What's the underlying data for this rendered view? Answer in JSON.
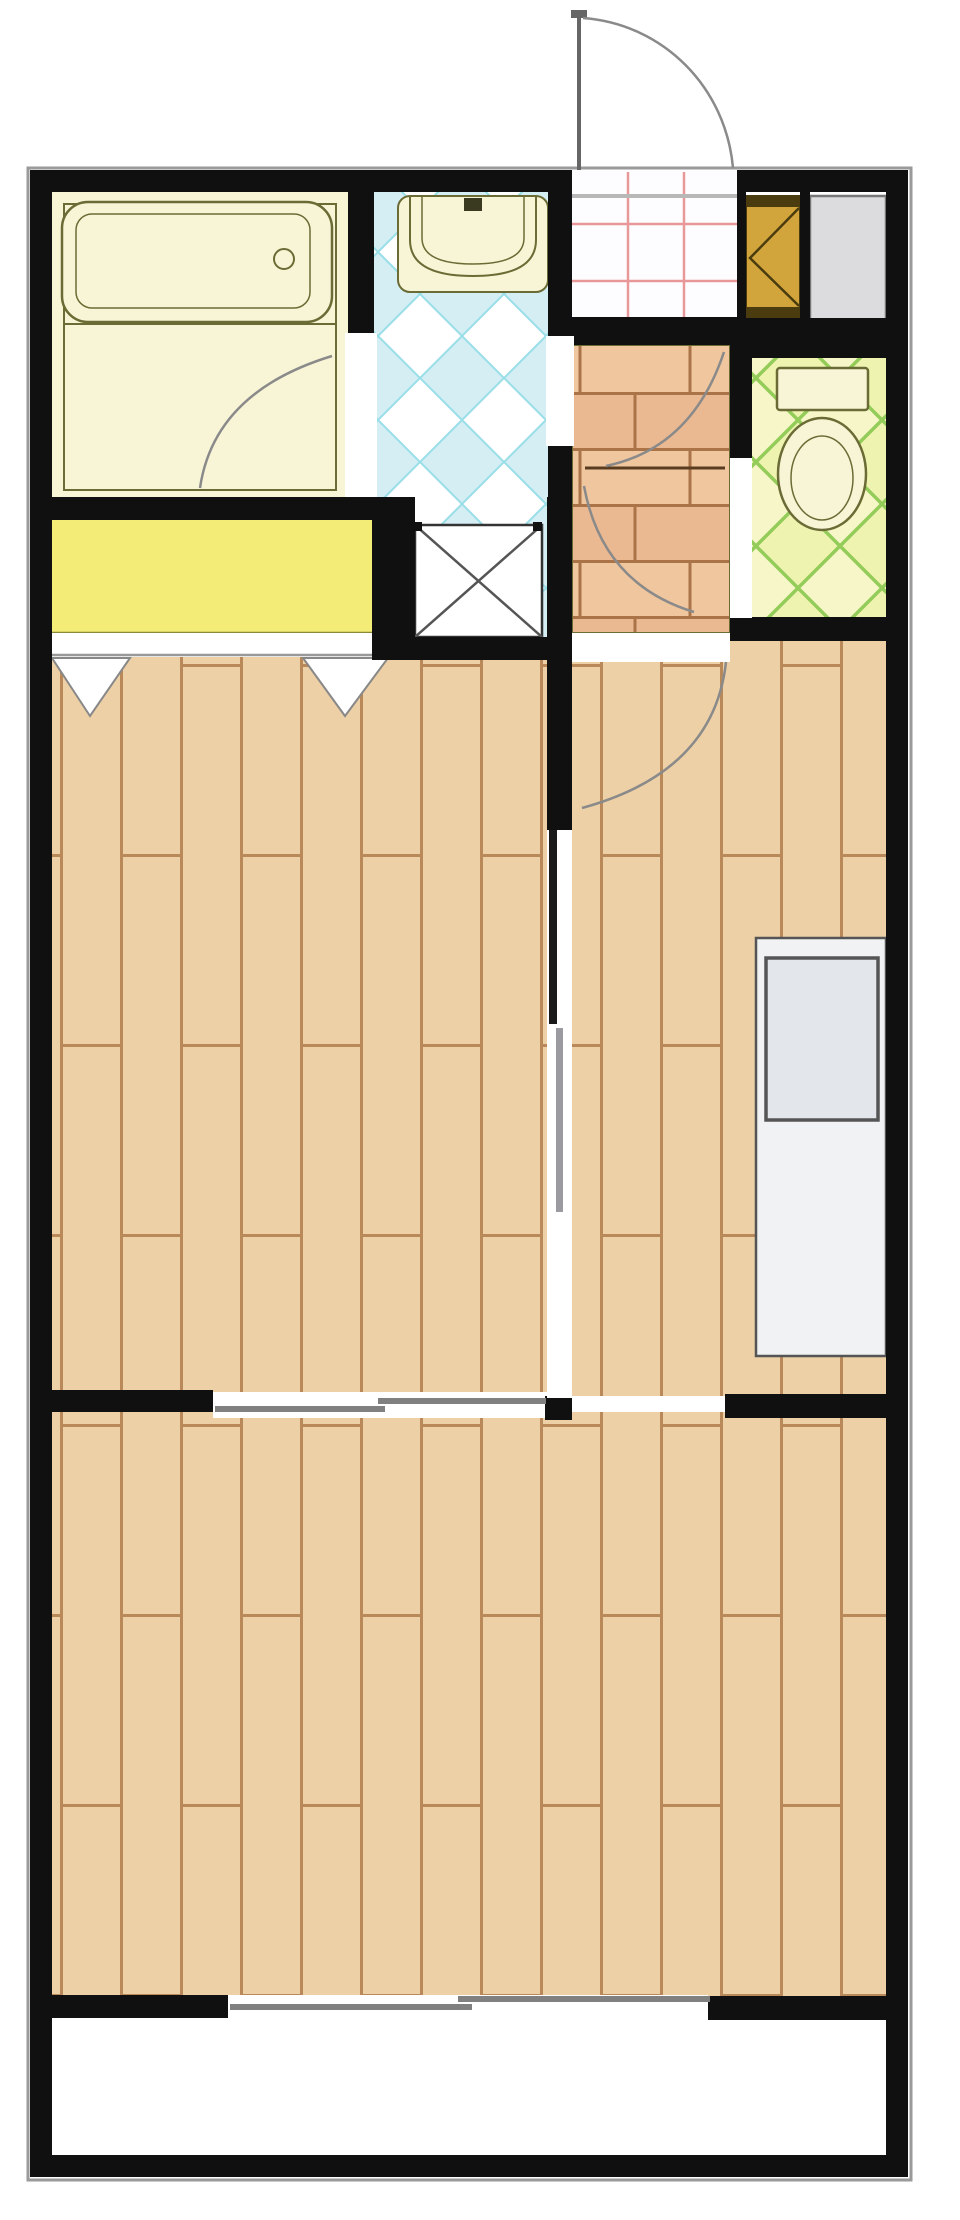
{
  "title": "apartment-floor-plan",
  "palette": {
    "wall": "#101010",
    "outline": "#9a9a9a",
    "white": "#ffffff",
    "wood_base": "#edd0a6",
    "wood_line": "#b9895a",
    "brick_base": "#efc69e",
    "brick_alt": "#eab992",
    "brick_line": "#aa7448",
    "bath_fill": "#f8f5d6",
    "fixture_line": "#6b6b35",
    "counter_yellow": "#f3ec77",
    "counter_yellow_line": "#8a8a3a",
    "tile_blue_bg": "#ffffff",
    "tile_blue_fill": "#d4eef3",
    "tile_blue_line": "#9adfe8",
    "tile_green_bg": "#f6f6c8",
    "tile_green_fill": "#eef4b0",
    "tile_green_line": "#93cc58",
    "genkan_bg": "#fdfdff",
    "genkan_line": "#e89898",
    "cabinet_fill": "#d2a53c",
    "cabinet_line": "#4a3c0e",
    "storage_fill": "#dcdcde",
    "storage_line": "#777777",
    "kitchen_fill": "#f0f2f4",
    "kitchen_sink": "#e3e6ea",
    "kitchen_line": "#555555",
    "door_line": "#5a3c20",
    "swing_line": "#8a8a8a",
    "window_line": "#808080",
    "xbox_line": "#333333"
  },
  "floorplan": {
    "rooms": [
      {
        "name": "bathroom",
        "floor": "unit-bath-yellow"
      },
      {
        "name": "washroom",
        "floor": "blue-diamond-tile"
      },
      {
        "name": "entrance-genkan",
        "floor": "white-pink-grid-tile"
      },
      {
        "name": "hallway",
        "floor": "brick-tile"
      },
      {
        "name": "toilet-room",
        "floor": "green-diamond-tile"
      },
      {
        "name": "west-room",
        "floor": "wood-plank"
      },
      {
        "name": "east-living-dining-kitchen",
        "floor": "wood-plank"
      },
      {
        "name": "south-room",
        "floor": "wood-plank"
      },
      {
        "name": "balcony",
        "floor": "plain-white"
      }
    ],
    "fixtures": [
      {
        "name": "bathtub",
        "room": "bathroom"
      },
      {
        "name": "vanity-sink",
        "room": "washroom"
      },
      {
        "name": "washer-pan-x-box",
        "room": "washroom"
      },
      {
        "name": "yellow-counter-closet",
        "room": "washroom-side"
      },
      {
        "name": "closet-fold-doors",
        "room": "west-room"
      },
      {
        "name": "shoe-cabinet",
        "room": "entrance-genkan"
      },
      {
        "name": "storage-unit",
        "room": "entrance-genkan"
      },
      {
        "name": "toilet",
        "room": "toilet-room"
      },
      {
        "name": "kitchen-counter-sink",
        "room": "east-living-dining-kitchen"
      }
    ],
    "doors": [
      {
        "name": "entrance-door",
        "type": "swing-out"
      },
      {
        "name": "bathroom-door",
        "type": "swing"
      },
      {
        "name": "hallway-upper-door",
        "type": "swing"
      },
      {
        "name": "hallway-lower-door",
        "type": "swing"
      },
      {
        "name": "ldk-door",
        "type": "swing"
      },
      {
        "name": "toilet-door-opening",
        "type": "opening"
      }
    ],
    "windows": [
      {
        "name": "room-divider-sliding-door"
      },
      {
        "name": "balcony-sliding-window"
      }
    ]
  }
}
